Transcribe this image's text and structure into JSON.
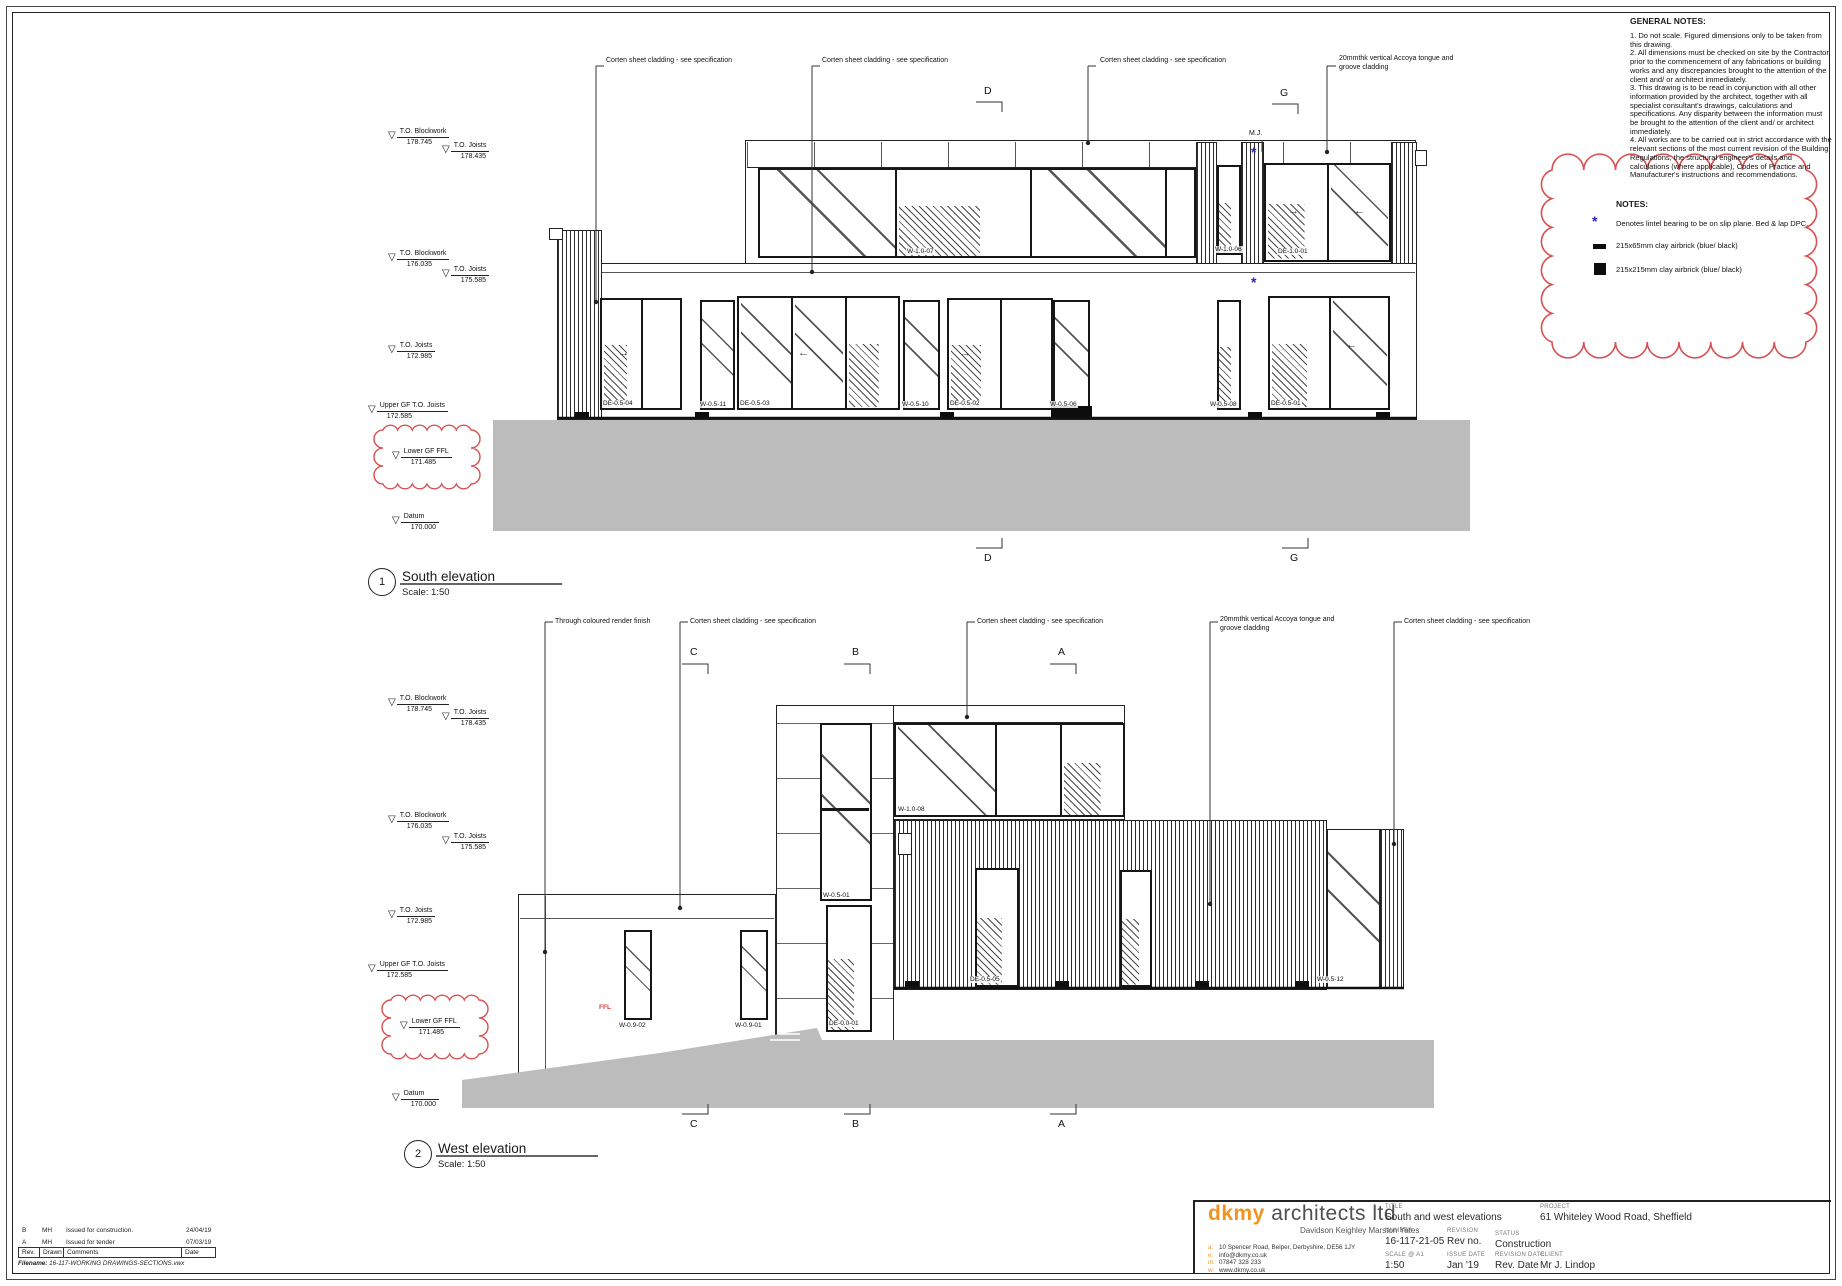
{
  "colors": {
    "accent_orange": "#f0941e",
    "cloud_red": "#d94f4f",
    "marker_blue": "#2424cc",
    "ground_gray": "#bcbcbc"
  },
  "levels": [
    {
      "name": "T.O. Blockwork",
      "value": "178.745"
    },
    {
      "name": "T.O. Joists",
      "value": "178.435"
    },
    {
      "name": "T.O. Blockwork",
      "value": "176.035"
    },
    {
      "name": "T.O. Joists",
      "value": "175.585"
    },
    {
      "name": "T.O. Joists",
      "value": "172.985"
    },
    {
      "name": "Upper GF T.O. Joists",
      "value": "172.585"
    },
    {
      "name": "Lower GF FFL",
      "value": "171.485"
    },
    {
      "name": "Datum",
      "value": "170.000"
    }
  ],
  "south": {
    "number": "1",
    "title": "South elevation",
    "scale": "Scale: 1:50",
    "callouts": [
      "Corten sheet cladding - see specification",
      "Corten sheet cladding - see specification",
      "Corten sheet cladding - see specification",
      "20mmthk vertical Accoya tongue and\ngroove cladding"
    ],
    "sections": [
      "D",
      "G"
    ],
    "mj": "M.J.",
    "window_labels": [
      "DE-0.5-04",
      "W-0.5-11",
      "DE-0.5-03",
      "W-0.5-10",
      "DE-0.5-02",
      "W-0.5-06",
      "W-0.5-08",
      "DE-0.5-01",
      "W-1.0-07",
      "W-1.0-06",
      "DE-1.0-01"
    ]
  },
  "west": {
    "number": "2",
    "title": "West elevation",
    "scale": "Scale: 1:50",
    "callouts": [
      "Through coloured render finish",
      "Corten sheet cladding - see specification",
      "Corten sheet cladding - see specification",
      "20mmthk vertical Accoya tongue and\ngroove cladding",
      "Corten sheet cladding - see specification"
    ],
    "sections": [
      "C",
      "B",
      "A"
    ],
    "ffl_note": "FFL",
    "window_labels": [
      "W-0.5-01",
      "DE-0.0-01",
      "W-0.9-02",
      "W-0.9-01",
      "W-1.0-08",
      "DE-0.5-05",
      "W-0.5-12"
    ]
  },
  "general_notes": {
    "title": "GENERAL NOTES:",
    "body": "1. Do not scale. Figured dimensions only to be taken from this drawing.\n2. All dimensions must be checked on site by the Contractor prior to the commencement of any fabrications or building works and any discrepancies brought to the attention of the client and/ or architect immediately.\n3. This drawing is to be read in conjunction with all other information provided by the architect, together with all specialist consultant's drawings, calculations and specifications. Any disparity between the information must be brought to the attention of the client and/ or architect immediately.\n4. All works are to be carried out in strict accordance with the relevant sections of the most current revision of the Building Regulations, the structural engineer's details and calculations (where applicable), Codes of Practice and Manufacturer's instructions and recommendations."
  },
  "notes_box": {
    "title": "NOTES:",
    "items": [
      {
        "symbol": "blue-asterisk",
        "text": "Denotes lintel bearing to be on slip plane. Bed & lap DPC."
      },
      {
        "symbol": "airbrick-small",
        "text": "215x65mm clay airbrick (blue/ black)"
      },
      {
        "symbol": "airbrick-large",
        "text": "215x215mm clay airbrick (blue/ black)"
      }
    ]
  },
  "titleblock": {
    "firm": "dkmy",
    "firm_rest": " architects ltd",
    "tagline": "Davidson Keighley Marston Yates",
    "contact": [
      {
        "k": "a:",
        "v": "10 Spencer Road, Belper, Derbyshire, DE56 1JY"
      },
      {
        "k": "e:",
        "v": "info@dkmy.co.uk"
      },
      {
        "k": "m:",
        "v": "07847 328 233"
      },
      {
        "k": "w:",
        "v": "www.dkmy.co.uk"
      }
    ],
    "fields": {
      "title_label": "TITLE",
      "title": "South and west elevations",
      "number_label": "NUMBER",
      "number": "16-117-21-05",
      "revision_label": "REVISION",
      "revision": "Rev no.",
      "status_label": "STATUS",
      "status": "Construction",
      "scale_label": "SCALE @ A1",
      "scale": "1:50",
      "issue_date_label": "ISSUE DATE",
      "issue_date": "Jan '19",
      "revision_date_label": "REVISION DATE",
      "revision_date": "Rev. Date",
      "project_label": "PROJECT",
      "project": "61 Whiteley Wood Road, Sheffield",
      "client_label": "CLIENT",
      "client": "Mr J. Lindop"
    }
  },
  "revision_table": {
    "headers": [
      "Rev.",
      "Drawn",
      "Comments",
      "Date"
    ],
    "rows": [
      {
        "rev": "B",
        "drawn": "MH",
        "comment": "Issued for construction.",
        "date": "24/04/19"
      },
      {
        "rev": "A",
        "drawn": "MH",
        "comment": "Issued for tender",
        "date": "07/03/19"
      }
    ],
    "filename_label": "Filename:",
    "filename": "16-117-WORKING DRAWINGS-SECTIONS.vwx"
  }
}
